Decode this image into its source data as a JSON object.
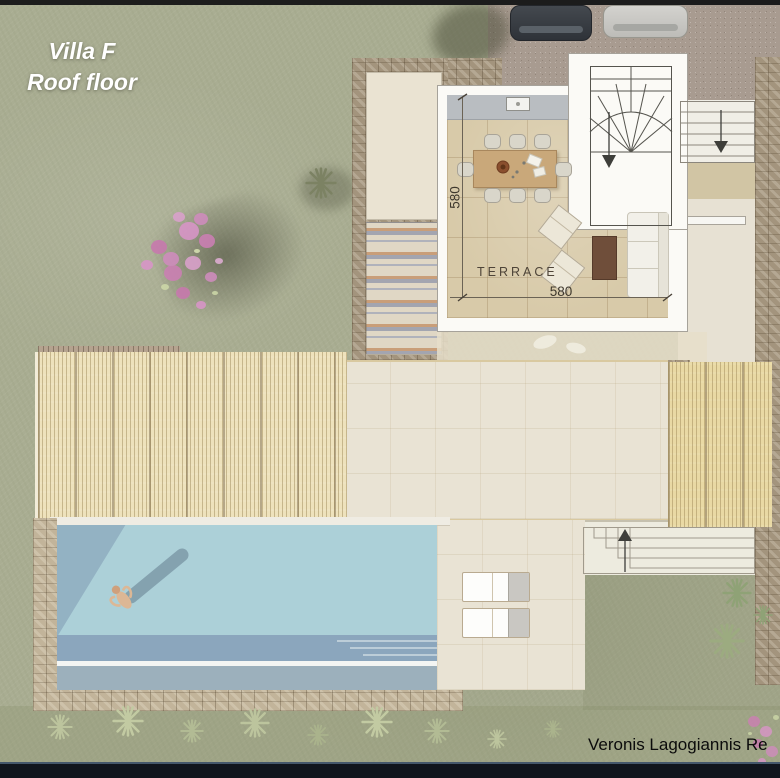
{
  "header": {
    "title_line1": "Villa F",
    "title_line2": "Roof floor"
  },
  "plan": {
    "room_label": "TERRACE",
    "dim_depth_cm": "580",
    "dim_width_cm": "580"
  },
  "footer": {
    "watermark": "Veronis Lagogiannis Re"
  },
  "icons": {
    "stairwell_arrow": "down-arrow",
    "side_steps_arrow": "down-arrow",
    "garden_steps_arrow": "up-arrow",
    "plants": "starburst-shrub"
  },
  "colors": {
    "lawn": "#a9ad92",
    "gravel": "#a89b90",
    "stone": "#a3947d",
    "tile_floor": "#d8caa9",
    "deck": "#e9e3d4",
    "pergola_reed": "#eee2bc",
    "pool_shallow": "#acd0d8",
    "pool_shadow": "#93b2c3",
    "pool_deep": "#8ba6bd",
    "wall_white": "#fbfaf6",
    "dining_table_wood": "#c9a87a",
    "flower_pink": "#d08cbe",
    "footer_bar": "#10151d"
  }
}
